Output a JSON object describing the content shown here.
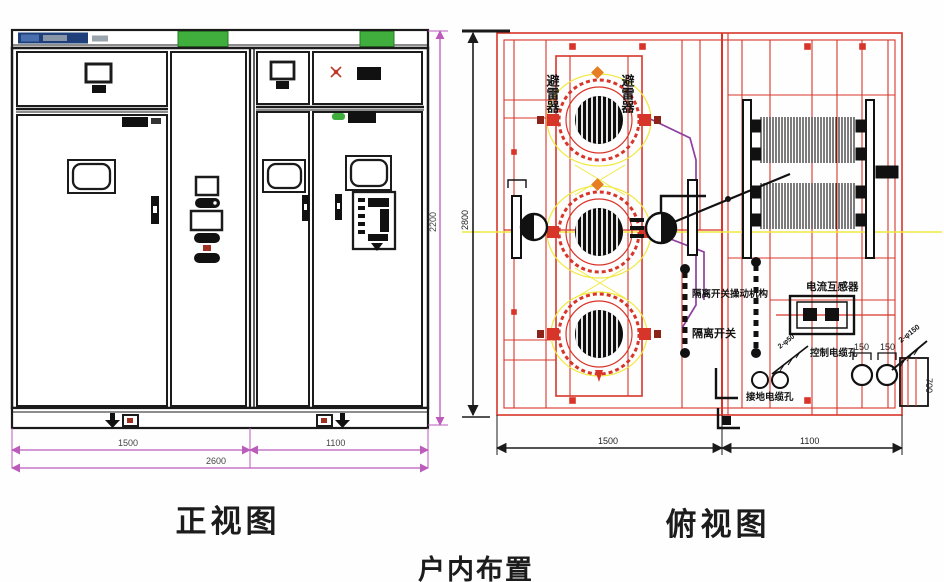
{
  "page": {
    "caption": "户内布置"
  },
  "front_view": {
    "title": "正视图",
    "dimensions": {
      "left_width": "1500",
      "right_width": "1100",
      "total_width": "2600",
      "height": "2200"
    }
  },
  "top_view": {
    "title": "俯视图",
    "dimensions": {
      "left_width": "1500",
      "right_width": "1100",
      "depth": "2800",
      "cable_box_depth": "700",
      "hole_span_left": "150",
      "hole_span_right": "150"
    },
    "labels": {
      "arrester_left": "避雷器",
      "arrester_right": "避雷器",
      "switch_mechanism": "隔离开关操动机构",
      "isolator_switch": "隔离开关",
      "current_transformer": "电流互感器",
      "control_cable_hole": "控制电缆孔",
      "ground_cable_hole": "接地电缆孔",
      "hole_spec_large": "2-φ150",
      "hole_spec_small": "2-φ50"
    }
  },
  "colors": {
    "frame_red": "#d8352a",
    "accent_yellow": "#efe93e",
    "accent_purple": "#8f3f9f",
    "accent_green": "#3fae3c",
    "nameplate_blue": "#1e3f7a",
    "dimension_magenta": "#bb5cbb"
  }
}
